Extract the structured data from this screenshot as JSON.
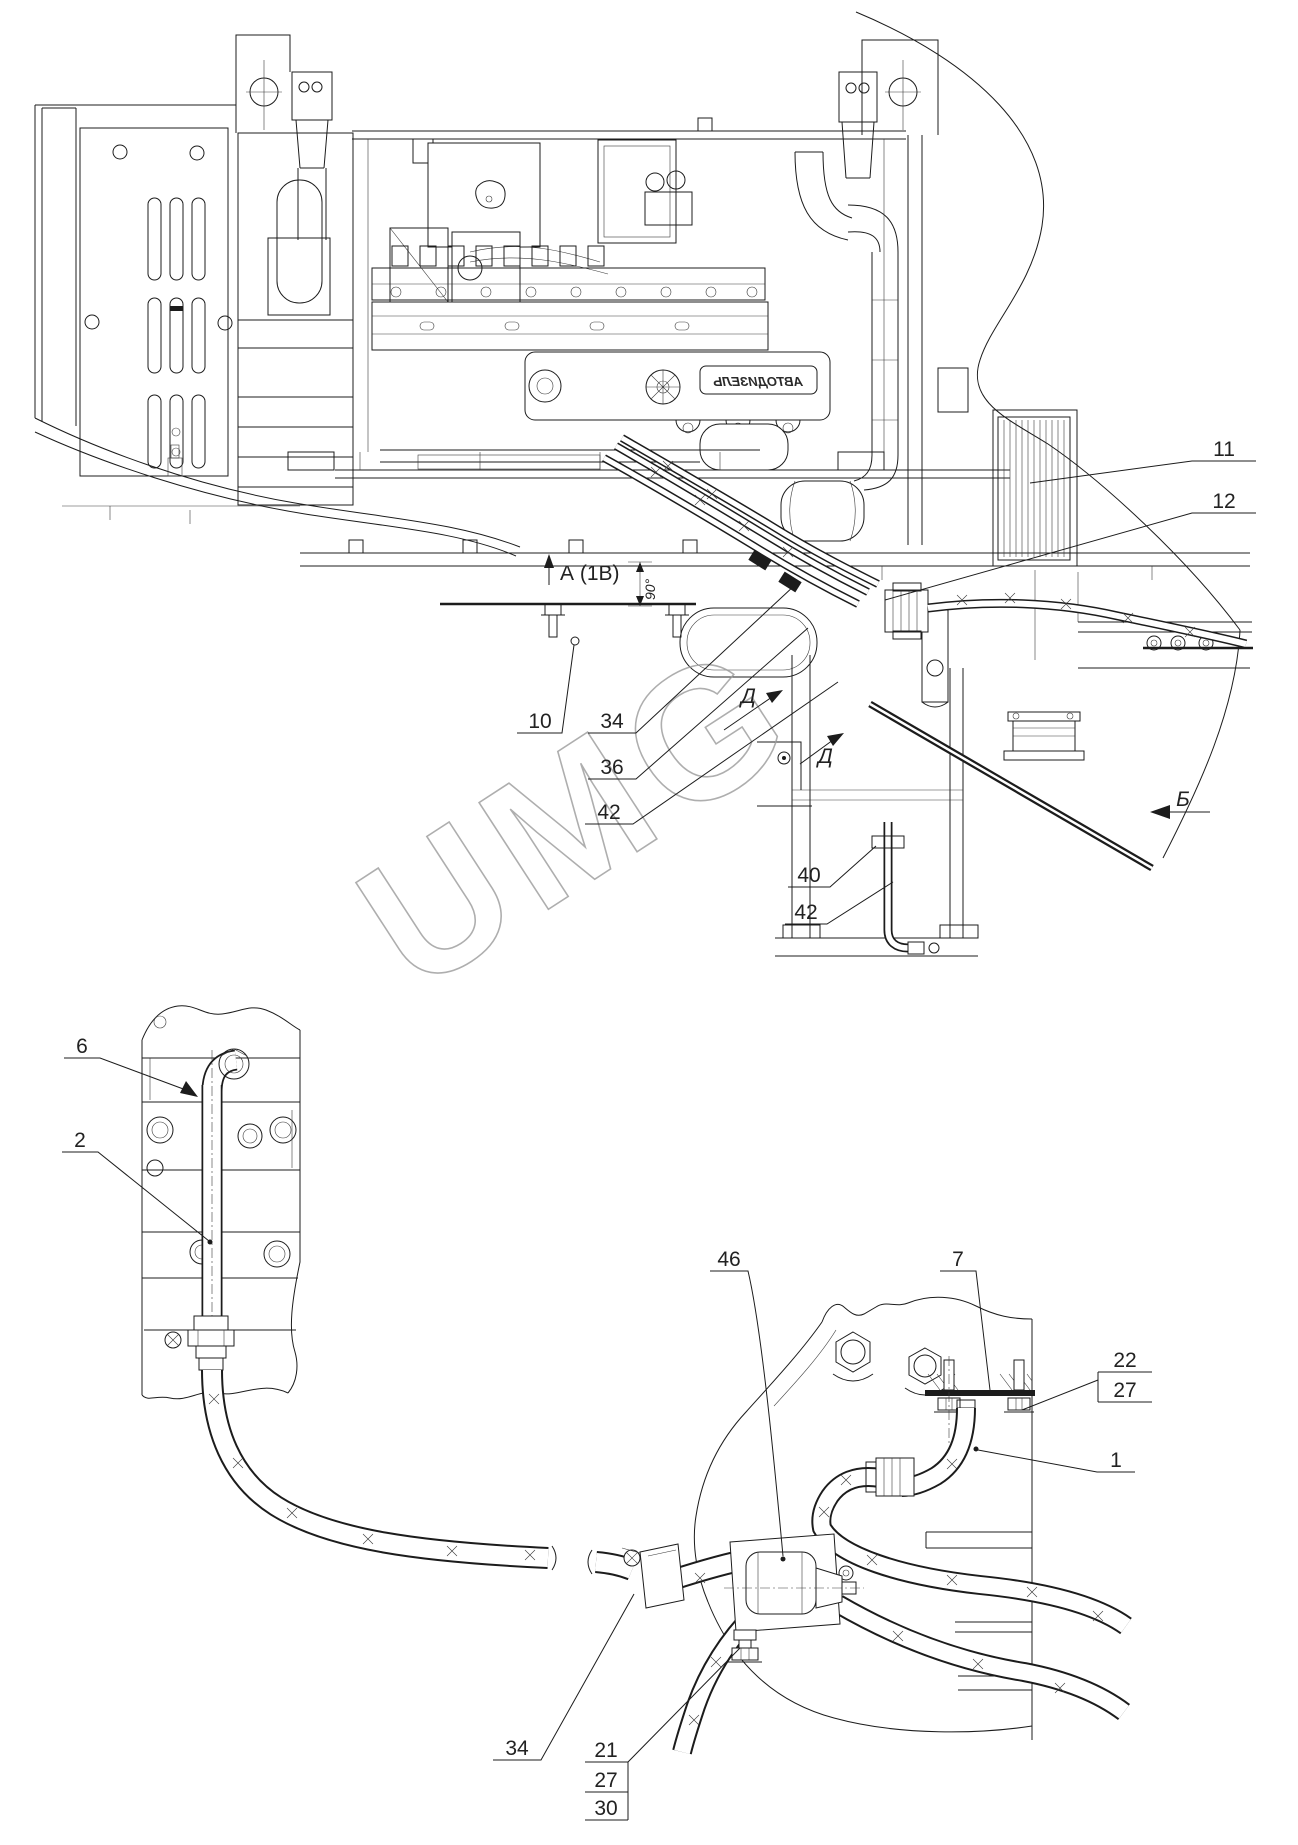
{
  "drawing": {
    "watermark_text": "UMG",
    "engine_logo": "АВТОДИЗЕЛЬ",
    "colors": {
      "line": "#1c1c1c",
      "watermark": "#9b9b9b",
      "background": "#ffffff"
    }
  },
  "main_view": {
    "view_arrow_a": {
      "label": "А (1В)"
    },
    "dimension_90": {
      "label": "90°"
    },
    "view_arrow_d_upper": {
      "label": "Д"
    },
    "view_arrow_d_lower": {
      "label": "Д"
    },
    "view_arrow_b": {
      "label": "Б"
    },
    "callouts": {
      "c11": {
        "label": "11"
      },
      "c12": {
        "label": "12"
      },
      "c10": {
        "label": "10"
      },
      "c34": {
        "label": "34"
      },
      "c36": {
        "label": "36"
      },
      "c42_upper": {
        "label": "42"
      },
      "c40": {
        "label": "40"
      },
      "c42_lower": {
        "label": "42"
      }
    }
  },
  "left_detail": {
    "callouts": {
      "c6": {
        "label": "6"
      },
      "c2": {
        "label": "2"
      }
    }
  },
  "right_detail": {
    "callouts": {
      "c46": {
        "label": "46"
      },
      "c7": {
        "label": "7"
      },
      "c22": {
        "label": "22"
      },
      "c27_upper": {
        "label": "27"
      },
      "c1": {
        "label": "1"
      },
      "c34": {
        "label": "34"
      },
      "c21": {
        "label": "21"
      },
      "c27_lower": {
        "label": "27"
      },
      "c30": {
        "label": "30"
      }
    }
  }
}
